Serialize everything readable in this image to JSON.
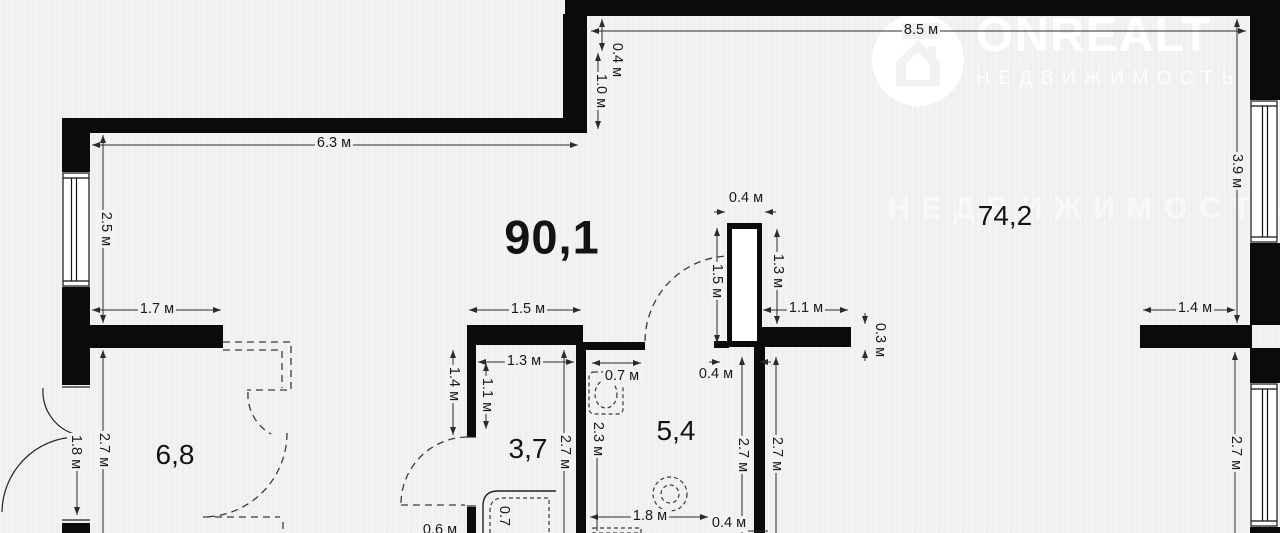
{
  "watermark": {
    "brand": "ONREALT",
    "subtitle": "НЕДВИЖИМОСТЬ"
  },
  "areas": {
    "total": "90,1",
    "living": "74,2",
    "hall": "6,8",
    "small_room": "3,7",
    "bathroom": "5,4"
  },
  "dims": {
    "top_width": "8.5 м",
    "wall_offset": "0.4 м",
    "top_inset": "1.0 м",
    "upper_left_width": "6.3 м",
    "left_height": "2.5 м",
    "hall_top_width": "1.7 м",
    "right_height": "3.9 м",
    "right_nook_width": "1.4 м",
    "shaft_width": "0.4 м",
    "shaft_height": "1.5 м",
    "shaft_right_height": "1.3 м",
    "ledge_width": "1.1 м",
    "ledge_thickness": "0.3 м",
    "shaft_bottom_gap": "0.4 м",
    "closet_wall_width": "1.5 м",
    "closet_left_height": "1.4 м",
    "closet_inner_height": "1.1 м",
    "small_room_width": "1.3 м",
    "small_room_height": "2.7 м",
    "basin_nook_width": "0.7 м",
    "bath_left_height": "2.3 м",
    "bath_height": "2.7 м",
    "living_lower_height": "2.7 м",
    "bath_width": "1.8 м",
    "bath_corner": "0.4 м",
    "bottom_cut": "0.6 м",
    "entry_door_width": "1.8 м",
    "hall_height": "2.7 м",
    "window_height": "2.7 м",
    "shower_width": "0.7"
  },
  "colors": {
    "wall": "#0b0b0b",
    "dimension_line": "#2b2b2b",
    "background": "#f4f2f0",
    "watermark": "#ffffff"
  }
}
